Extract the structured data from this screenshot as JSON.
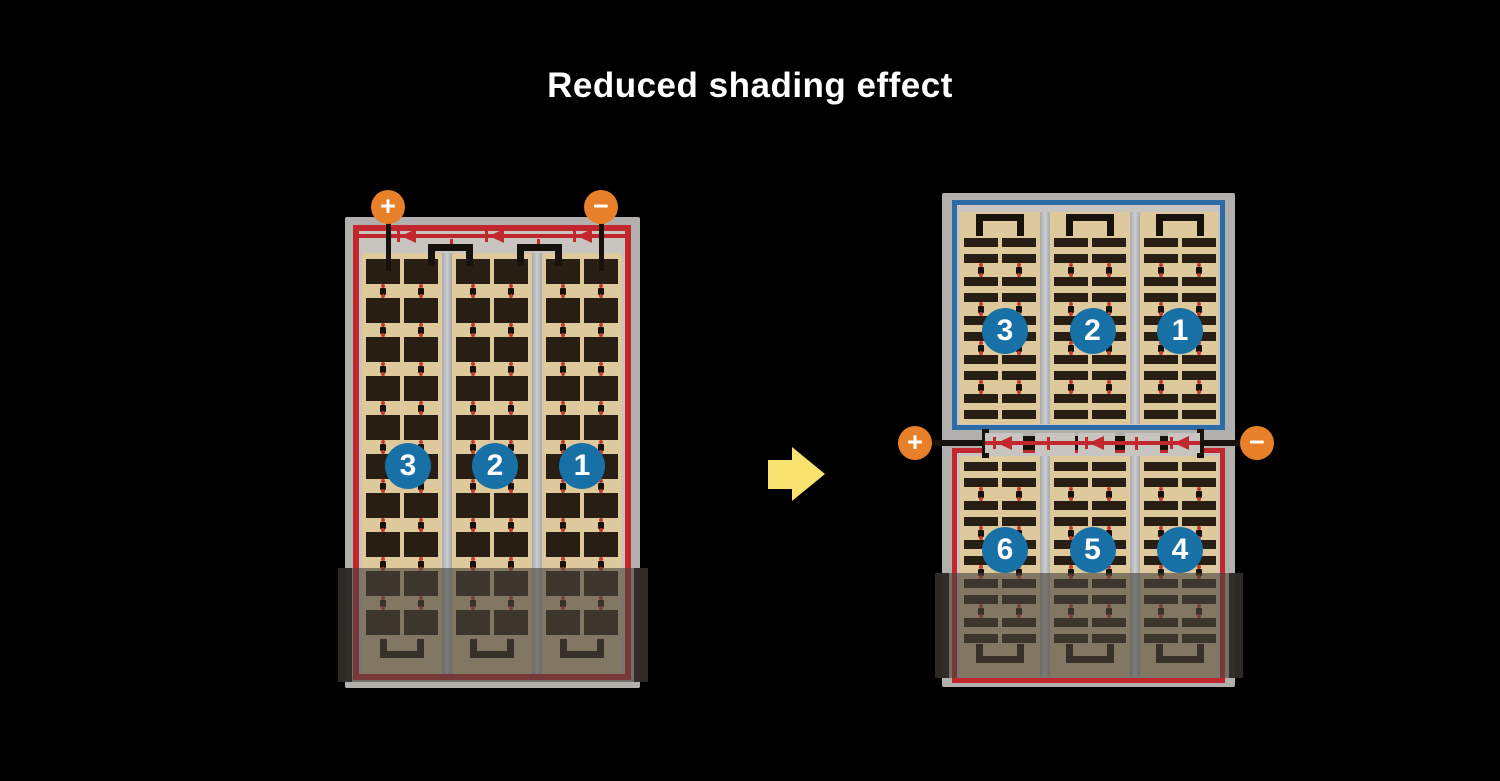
{
  "title": "Reduced shading effect",
  "colors": {
    "background": "#000000",
    "title_text": "#ffffff",
    "frame_gray": "#b2b0ad",
    "panel_inner_gray": "#c8c5c1",
    "cell_mat_tan": "#dec99d",
    "cell_dark": "#281e13",
    "busbar_light": "#cdced1",
    "busbar_dark": "#a6a8ad",
    "wire_black": "#18120c",
    "circuit_red": "#c1272d",
    "dot_red": "#c0392b",
    "series_blue": "#2e6ca8",
    "badge_blue": "#1871a6",
    "terminal_orange": "#e8802a",
    "arrow_yellow": "#f9e26d"
  },
  "left_panel": {
    "terminals": {
      "positive": "+",
      "negative": "−"
    },
    "strings": [
      "3",
      "2",
      "1"
    ],
    "diode_count": 3,
    "shaded_area": "bottom"
  },
  "flow_arrow": {
    "direction": "right"
  },
  "right_assembly": {
    "terminals": {
      "positive": "+",
      "negative": "−"
    },
    "top_panel": {
      "border_color": "#2e6ca8",
      "strings": [
        "3",
        "2",
        "1"
      ]
    },
    "bottom_panel": {
      "border_color": "#c1272d",
      "strings": [
        "6",
        "5",
        "4"
      ],
      "shaded_area": "bottom"
    },
    "junction_diode_count": 3
  },
  "structure": {
    "columns_per_panel": 3,
    "sub_columns_per_column": 2,
    "full_cell_rows": 10,
    "half_cell_row_pairs_top": 5,
    "half_cell_row_pairs_bottom": 5
  }
}
